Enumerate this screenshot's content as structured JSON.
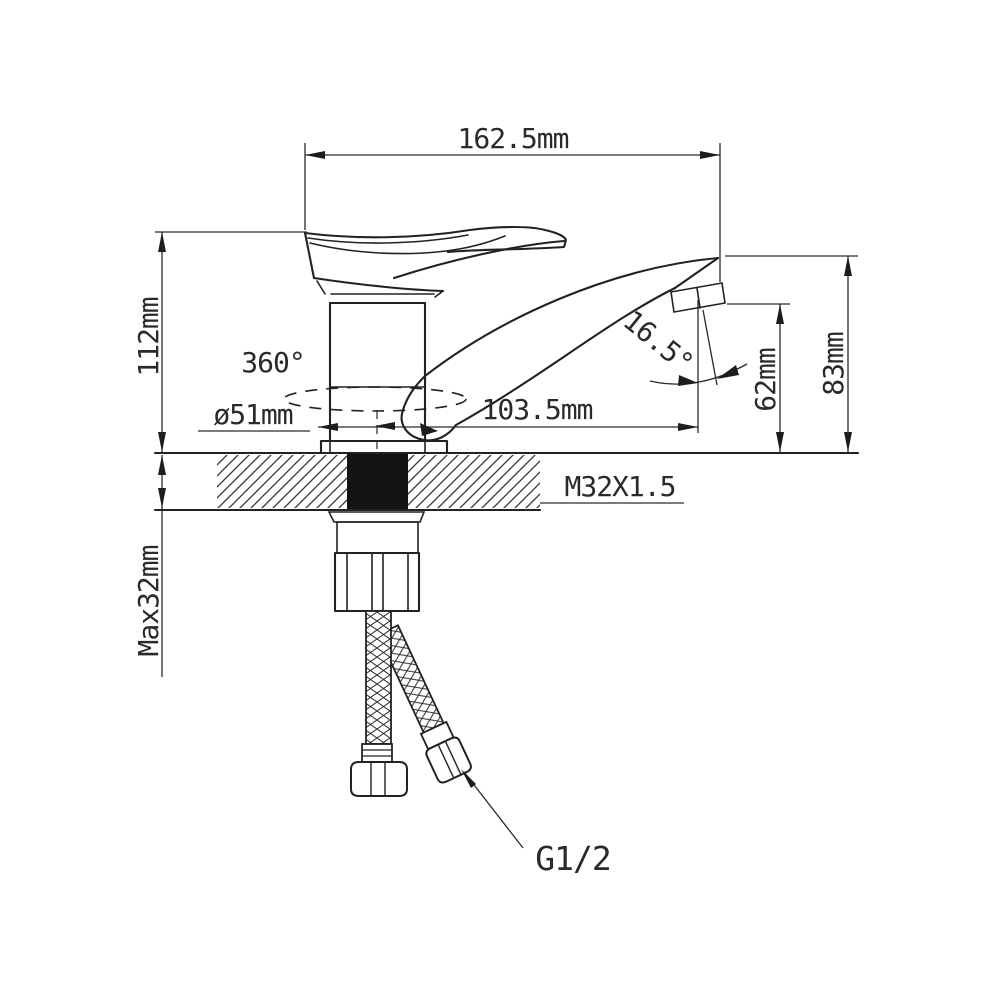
{
  "drawing": {
    "type": "faucet-technical-dimension-drawing",
    "labels": {
      "width_top": "162.5mm",
      "height_body": "112mm",
      "swivel": "360°",
      "base_diameter": "ø51mm",
      "spout_reach": "103.5mm",
      "spout_angle": "16.5°",
      "height_aerator": "62mm",
      "height_spout": "83mm",
      "mount_thread": "M32X1.5",
      "deck_thickness_max": "Max32mm",
      "hose_thread": "G1/2"
    },
    "colors": {
      "line": "#222222",
      "dimension_line": "#2a2a2a",
      "text": "#2a2a2a",
      "thread_fill": "#141414",
      "background": "#ffffff"
    }
  }
}
